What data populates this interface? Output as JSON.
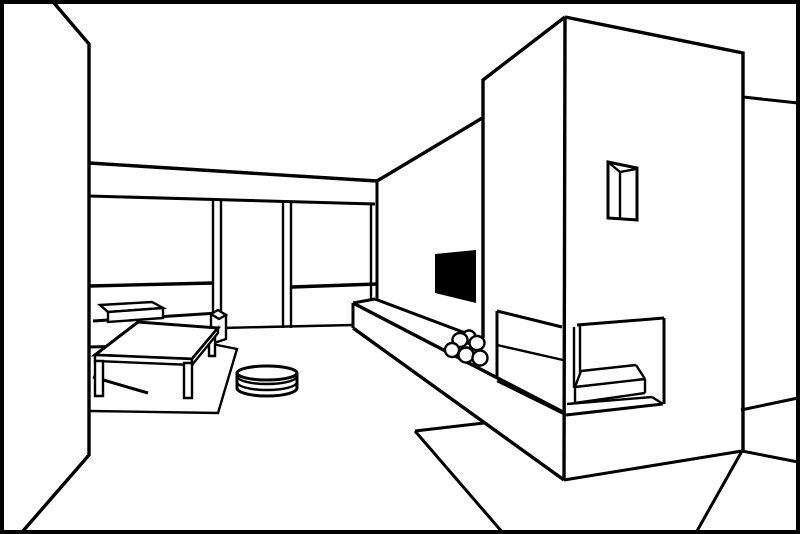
{
  "scene": {
    "description": "Black and white line drawing of a modern living room interior in perspective: a low sofa with a side shelf box, a rectangular coffee table on an area rug, a round floor pouf, a wall-mounted TV, a long hearth bench with a stack of firewood logs, and a tall corner fireplace column with a small vent window and an open two-sided firebox with an interior seat slab.",
    "style": "line-art coloring-page illustration, no text",
    "colors": {
      "ink": "#000000",
      "background": "#ffffff",
      "tv_screen": "#000000"
    },
    "counts": {
      "firewood_logs": 6,
      "sliding_door_frames": 2,
      "coffee_table_legs_visible": 3
    },
    "objects": [
      {
        "name": "left-wall"
      },
      {
        "name": "back-wall-with-sliding-doors"
      },
      {
        "name": "window-sill-rails"
      },
      {
        "name": "right-wall"
      },
      {
        "name": "tv-screen"
      },
      {
        "name": "sofa"
      },
      {
        "name": "sofa-side-shelf"
      },
      {
        "name": "coffee-table"
      },
      {
        "name": "area-rug"
      },
      {
        "name": "floor-pouf"
      },
      {
        "name": "hearth-bench"
      },
      {
        "name": "firewood-logs"
      },
      {
        "name": "fireplace-column"
      },
      {
        "name": "fireplace-vent-window"
      },
      {
        "name": "firebox-opening"
      },
      {
        "name": "hearth-mat"
      },
      {
        "name": "floor"
      }
    ]
  }
}
